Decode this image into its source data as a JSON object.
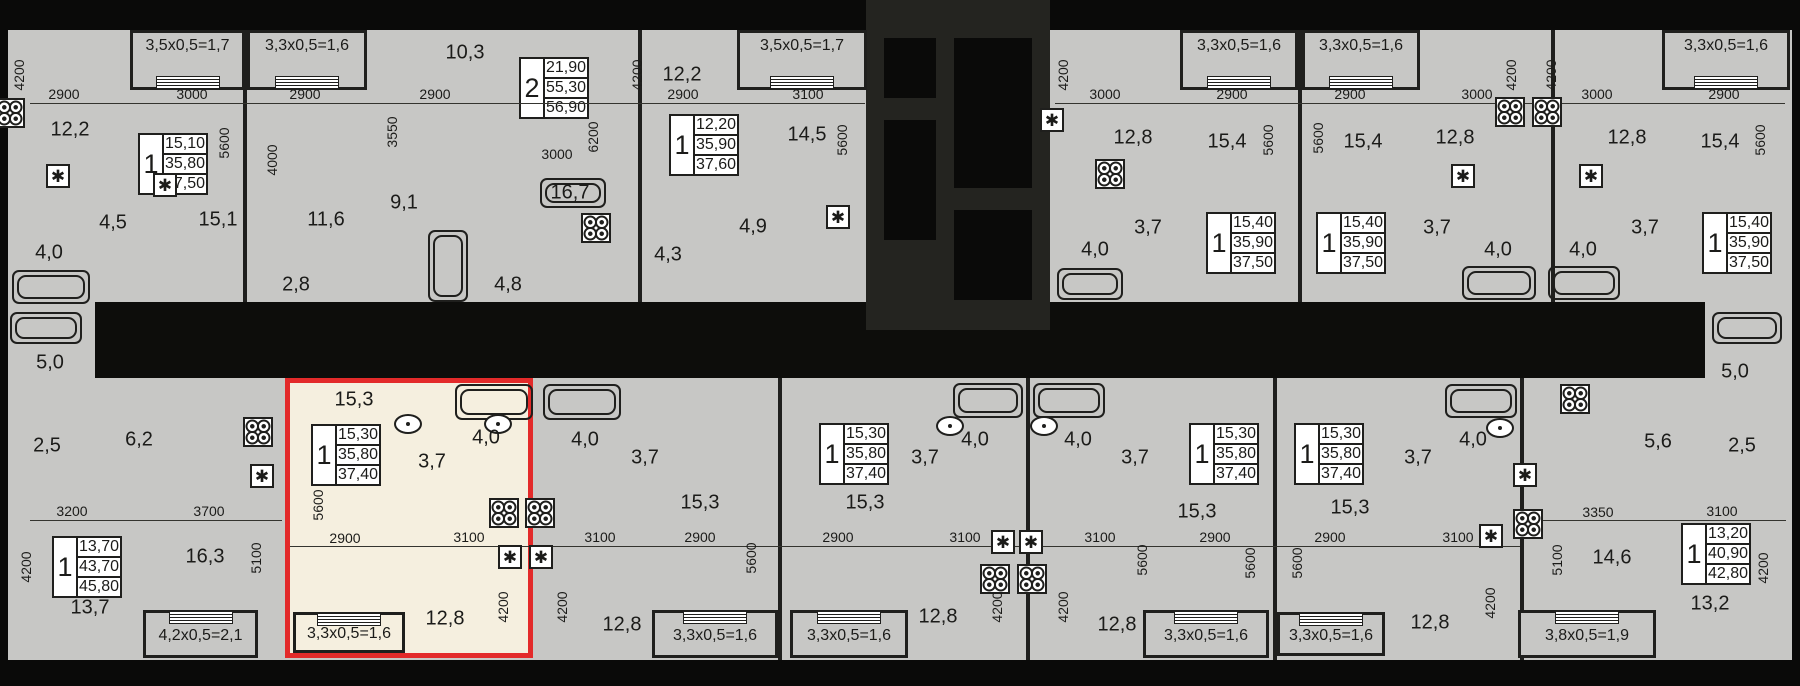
{
  "plan_title": "Residential floor plan with selected apartment",
  "colors": {
    "background": "#0a0a09",
    "unit_fill": "#c7c7c5",
    "highlight_fill": "#f5efdf",
    "highlight_border": "#e32a2a",
    "wall": "#1f1f1d",
    "text": "#1b1b19",
    "info_fill": "#ffffff"
  },
  "selected_apartment": {
    "rooms": "1",
    "living_area": "15,30",
    "area": "35,80",
    "total_area": "37,40"
  },
  "units": [
    {
      "rooms": "1",
      "a1": "15,10",
      "a2": "35,80",
      "a3": "37,50"
    },
    {
      "rooms": "2",
      "a1": "21,90",
      "a2": "55,30",
      "a3": "56,90"
    },
    {
      "rooms": "1",
      "a1": "12,20",
      "a2": "35,90",
      "a3": "37,60"
    },
    {
      "rooms": "1",
      "a1": "15,40",
      "a2": "35,90",
      "a3": "37,50"
    },
    {
      "rooms": "1",
      "a1": "15,40",
      "a2": "35,90",
      "a3": "37,50"
    },
    {
      "rooms": "1",
      "a1": "15,40",
      "a2": "35,90",
      "a3": "37,50"
    },
    {
      "rooms": "1",
      "a1": "13,70",
      "a2": "43,70",
      "a3": "45,80"
    },
    {
      "rooms": "1",
      "a1": "15,30",
      "a2": "35,80",
      "a3": "37,40"
    },
    {
      "rooms": "1",
      "a1": "15,30",
      "a2": "35,80",
      "a3": "37,40"
    },
    {
      "rooms": "1",
      "a1": "15,30",
      "a2": "35,80",
      "a3": "37,40"
    },
    {
      "rooms": "1",
      "a1": "15,30",
      "a2": "35,80",
      "a3": "37,40"
    },
    {
      "rooms": "1",
      "a1": "13,20",
      "a2": "40,90",
      "a3": "42,80"
    }
  ],
  "balconies": [
    {
      "label": "3,5х0,5=1,7"
    },
    {
      "label": "3,3х0,5=1,6"
    },
    {
      "label": "3,5х0,5=1,7"
    },
    {
      "label": "3,3х0,5=1,6"
    },
    {
      "label": "3,3х0,5=1,6"
    },
    {
      "label": "3,3х0,5=1,6"
    },
    {
      "label": "4,2х0,5=2,1"
    },
    {
      "label": "3,3х0,5=1,6"
    },
    {
      "label": "3,3х0,5=1,6"
    },
    {
      "label": "3,3х0,5=1,6"
    },
    {
      "label": "3,3х0,5=1,6"
    },
    {
      "label": "3,3х0,5=1,6"
    },
    {
      "label": "3,8х0,5=1,9"
    }
  ],
  "room_labels": [
    [
      "12,2",
      70,
      130
    ],
    [
      "4,5",
      113,
      223
    ],
    [
      "4,0",
      49,
      253
    ],
    [
      "15,1",
      218,
      220
    ],
    [
      "2,8",
      296,
      285
    ],
    [
      "11,6",
      326,
      220
    ],
    [
      "10,3",
      465,
      53
    ],
    [
      "9,1",
      404,
      203
    ],
    [
      "16,7",
      570,
      193
    ],
    [
      "4,8",
      508,
      285
    ],
    [
      "4,3",
      668,
      255
    ],
    [
      "12,2",
      682,
      75
    ],
    [
      "14,5",
      807,
      135
    ],
    [
      "4,9",
      753,
      227
    ],
    [
      "12,8",
      1133,
      138
    ],
    [
      "4,0",
      1095,
      250
    ],
    [
      "3,7",
      1148,
      228
    ],
    [
      "15,4",
      1227,
      142
    ],
    [
      "15,4",
      1363,
      142
    ],
    [
      "12,8",
      1455,
      138
    ],
    [
      "12,8",
      1627,
      138
    ],
    [
      "3,7",
      1437,
      228
    ],
    [
      "3,7",
      1645,
      228
    ],
    [
      "4,0",
      1498,
      250
    ],
    [
      "4,0",
      1583,
      250
    ],
    [
      "15,4",
      1720,
      142
    ],
    [
      "5,0",
      50,
      363
    ],
    [
      "2,5",
      47,
      446
    ],
    [
      "6,2",
      139,
      440
    ],
    [
      "16,3",
      205,
      557
    ],
    [
      "13,7",
      90,
      608
    ],
    [
      "15,3",
      354,
      400
    ],
    [
      "3,7",
      432,
      462
    ],
    [
      "4,0",
      486,
      438
    ],
    [
      "12,8",
      445,
      619
    ],
    [
      "4,0",
      585,
      440
    ],
    [
      "3,7",
      645,
      458
    ],
    [
      "15,3",
      700,
      503
    ],
    [
      "12,8",
      622,
      625
    ],
    [
      "15,3",
      865,
      503
    ],
    [
      "3,7",
      925,
      458
    ],
    [
      "4,0",
      975,
      440
    ],
    [
      "12,8",
      938,
      617
    ],
    [
      "4,0",
      1078,
      440
    ],
    [
      "3,7",
      1135,
      458
    ],
    [
      "12,8",
      1117,
      625
    ],
    [
      "15,3",
      1197,
      512
    ],
    [
      "15,3",
      1350,
      508
    ],
    [
      "3,7",
      1418,
      458
    ],
    [
      "4,0",
      1473,
      440
    ],
    [
      "12,8",
      1430,
      623
    ],
    [
      "14,6",
      1612,
      558
    ],
    [
      "5,6",
      1658,
      442
    ],
    [
      "5,0",
      1735,
      372
    ],
    [
      "2,5",
      1742,
      446
    ],
    [
      "13,2",
      1710,
      604
    ]
  ],
  "dim_labels": [
    [
      "2900",
      64,
      94,
      0
    ],
    [
      "3000",
      192,
      94,
      0
    ],
    [
      "2900",
      305,
      94,
      0
    ],
    [
      "2900",
      435,
      94,
      0
    ],
    [
      "3000",
      557,
      154,
      0
    ],
    [
      "2900",
      683,
      94,
      0
    ],
    [
      "3100",
      808,
      94,
      0
    ],
    [
      "3000",
      1105,
      94,
      0
    ],
    [
      "2900",
      1232,
      94,
      0
    ],
    [
      "2900",
      1350,
      94,
      0
    ],
    [
      "3000",
      1477,
      94,
      0
    ],
    [
      "3000",
      1597,
      94,
      0
    ],
    [
      "2900",
      1724,
      94,
      0
    ],
    [
      "4200",
      19,
      75,
      1
    ],
    [
      "5600",
      224,
      143,
      1
    ],
    [
      "4000",
      272,
      160,
      1
    ],
    [
      "3550",
      392,
      132,
      1
    ],
    [
      "6200",
      593,
      137,
      1
    ],
    [
      "4200",
      637,
      75,
      1
    ],
    [
      "5600",
      842,
      140,
      1
    ],
    [
      "4200",
      1063,
      75,
      1
    ],
    [
      "5600",
      1268,
      140,
      1
    ],
    [
      "5600",
      1318,
      138,
      1
    ],
    [
      "4200",
      1511,
      75,
      1
    ],
    [
      "4200",
      1551,
      75,
      1
    ],
    [
      "5600",
      1760,
      140,
      1
    ],
    [
      "3200",
      72,
      511,
      0
    ],
    [
      "3700",
      209,
      511,
      0
    ],
    [
      "2900",
      345,
      538,
      0
    ],
    [
      "3100",
      469,
      537,
      0
    ],
    [
      "3100",
      600,
      537,
      0
    ],
    [
      "2900",
      700,
      537,
      0
    ],
    [
      "2900",
      838,
      537,
      0
    ],
    [
      "3100",
      965,
      537,
      0
    ],
    [
      "3100",
      1100,
      537,
      0
    ],
    [
      "2900",
      1215,
      537,
      0
    ],
    [
      "2900",
      1330,
      537,
      0
    ],
    [
      "3100",
      1458,
      537,
      0
    ],
    [
      "3350",
      1598,
      512,
      0
    ],
    [
      "3100",
      1722,
      511,
      0
    ],
    [
      "4200",
      26,
      567,
      1
    ],
    [
      "5100",
      256,
      558,
      1
    ],
    [
      "5600",
      318,
      505,
      1
    ],
    [
      "4200",
      503,
      607,
      1
    ],
    [
      "4200",
      562,
      607,
      1
    ],
    [
      "5600",
      751,
      558,
      1
    ],
    [
      "4200",
      997,
      607,
      1
    ],
    [
      "4200",
      1063,
      607,
      1
    ],
    [
      "5600",
      1142,
      560,
      1
    ],
    [
      "5600",
      1250,
      563,
      1
    ],
    [
      "5600",
      1297,
      563,
      1
    ],
    [
      "4200",
      1490,
      603,
      1
    ],
    [
      "5100",
      1557,
      560,
      1
    ],
    [
      "4200",
      1763,
      568,
      1
    ]
  ],
  "icons": {
    "bathtubs": [
      [
        12,
        270,
        78,
        34
      ],
      [
        428,
        230,
        40,
        72
      ],
      [
        540,
        178,
        66,
        30
      ],
      [
        1057,
        268,
        66,
        32
      ],
      [
        1462,
        266,
        74,
        34
      ],
      [
        1548,
        266,
        72,
        34
      ],
      [
        10,
        312,
        72,
        32
      ],
      [
        1712,
        312,
        70,
        32
      ],
      [
        455,
        384,
        78,
        36
      ],
      [
        543,
        384,
        78,
        36
      ],
      [
        953,
        383,
        70,
        35
      ],
      [
        1033,
        383,
        72,
        35
      ],
      [
        1445,
        384,
        72,
        34
      ]
    ],
    "stoves": [
      [
        10,
        113
      ],
      [
        596,
        228
      ],
      [
        1110,
        174
      ],
      [
        1510,
        112
      ],
      [
        1547,
        112
      ],
      [
        258,
        432
      ],
      [
        504,
        513
      ],
      [
        540,
        513
      ],
      [
        995,
        579
      ],
      [
        1032,
        579
      ],
      [
        1528,
        524
      ],
      [
        1575,
        399
      ]
    ],
    "appliance_boxes": [
      [
        58,
        176
      ],
      [
        165,
        185
      ],
      [
        838,
        217
      ],
      [
        1052,
        120
      ],
      [
        1463,
        176
      ],
      [
        1591,
        176
      ],
      [
        262,
        476
      ],
      [
        510,
        557
      ],
      [
        541,
        557
      ],
      [
        1003,
        542
      ],
      [
        1031,
        542
      ],
      [
        1491,
        536
      ],
      [
        1525,
        475
      ]
    ],
    "sinks": [
      [
        408,
        424
      ],
      [
        498,
        424
      ],
      [
        950,
        426
      ],
      [
        1044,
        426
      ],
      [
        1500,
        428
      ]
    ],
    "appliance_glyph": "✱"
  },
  "dim_lines": [
    [
      30,
      103,
      835
    ],
    [
      1055,
      103,
      730
    ],
    [
      30,
      520,
      252
    ],
    [
      290,
      546,
      1230
    ],
    [
      1528,
      520,
      258
    ]
  ]
}
